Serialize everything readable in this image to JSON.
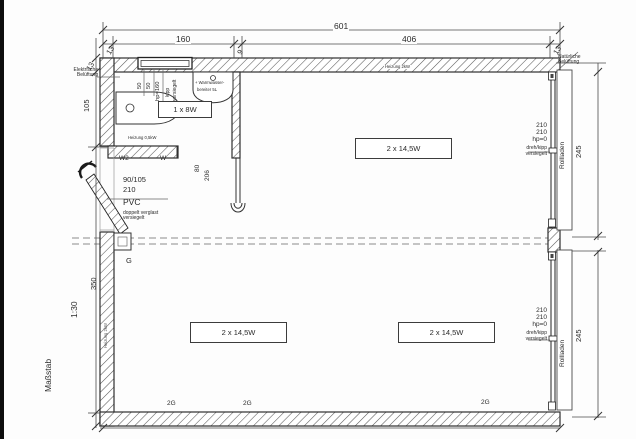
{
  "scale": {
    "word": "Maßstab",
    "value": "1:30"
  },
  "dims": {
    "total": "601",
    "bath_w": "160",
    "main_w": "406",
    "wall_left_top": "13",
    "wall_right_top": "13",
    "wall_side": "13",
    "partition": "9",
    "bath_h": "105",
    "main_h": "350",
    "win_upper": "245",
    "win_lower": "245",
    "door_w": "80",
    "door_h": "206",
    "win50_a": "50",
    "win50_b": "50"
  },
  "bath": {
    "window_hp": "hp=160",
    "window_type": "kipp",
    "window_sealed": "versiegelt",
    "light": "1 x 8W",
    "heating": "Heizung 0,5kW",
    "vent_line1": "Elektrische",
    "vent_line2": "Belüftung",
    "heater_line1": "+ Warmwasser-",
    "heater_line2": "bereiter 5L",
    "wall_w2": "W2",
    "wall_w": "W"
  },
  "door": {
    "size": "90/105",
    "height": "210",
    "material": "PVC",
    "glazing": "doppelt verglast",
    "sealed": "versiegelt"
  },
  "main": {
    "light": "2 x 14,5W",
    "circuit": "2G",
    "gas": "G",
    "heating_top": "Heizung 2kW",
    "heating_wall": "Heizung 2kW"
  },
  "rwin": {
    "h1": "210",
    "h2": "210",
    "hp": "hp=0",
    "type": "dreh/kipp",
    "sealed": "versiegelt",
    "shutter": "Rollladen",
    "vent_line1": "Natürliche",
    "vent_line2": "Belüftung"
  }
}
